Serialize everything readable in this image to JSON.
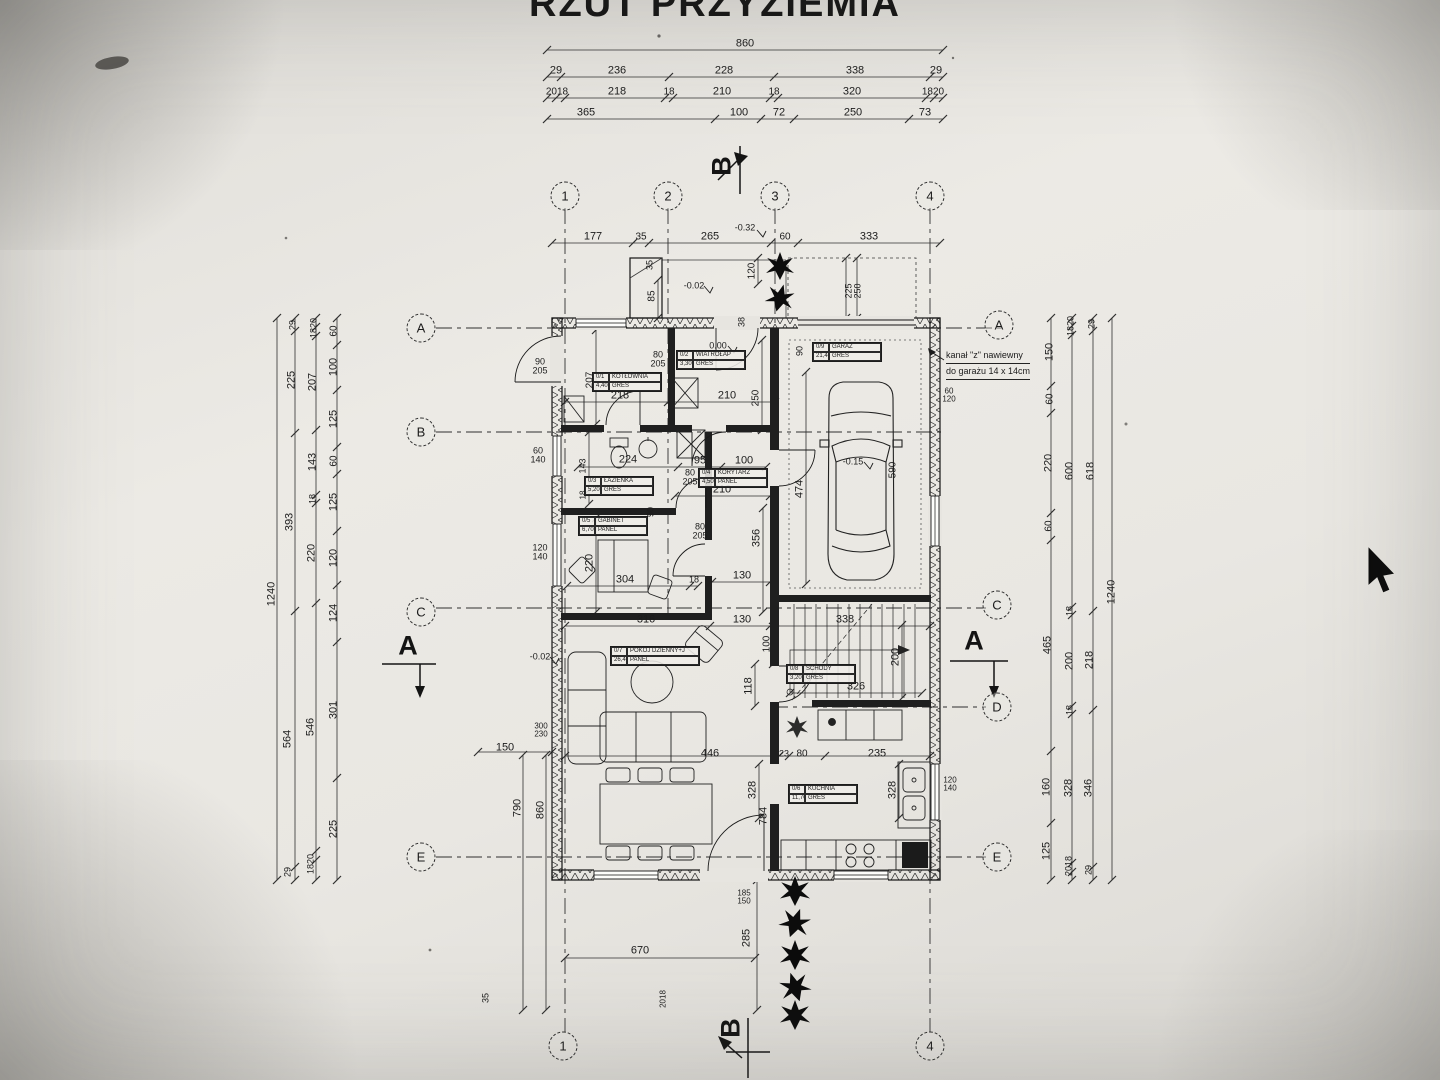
{
  "title": "RZUT PRZYZIEMIA",
  "note": {
    "line1": "kanał \"z\" nawiewny",
    "line2": "do garażu 14 x 14cm"
  },
  "rooms": [
    {
      "id": "0/1",
      "name": "KOTŁOWNIA",
      "area": "4,40m²",
      "floor": "GRES",
      "x": 592,
      "y": 372
    },
    {
      "id": "0/2",
      "name": "WIATROŁAP",
      "area": "3,30m²",
      "floor": "GRES",
      "x": 676,
      "y": 350
    },
    {
      "id": "0/3",
      "name": "ŁAZIENKA",
      "area": "5,20m²",
      "floor": "GRES",
      "x": 584,
      "y": 476
    },
    {
      "id": "0/4",
      "name": "KORYTARZ",
      "area": "4,50m²",
      "floor": "PANEL",
      "x": 698,
      "y": 468
    },
    {
      "id": "0/5",
      "name": "GABINET",
      "area": "6,70m²",
      "floor": "PANEL",
      "x": 578,
      "y": 516
    },
    {
      "id": "0/7",
      "name": "POKÓJ DZIENNY+J",
      "area": "26,40m²",
      "floor": "PANEL",
      "x": 610,
      "y": 646,
      "wide": true
    },
    {
      "id": "0/8",
      "name": "SCHODY",
      "area": "3,20m²",
      "floor": "GRES",
      "x": 786,
      "y": 664
    },
    {
      "id": "0/6",
      "name": "KUCHNIA",
      "area": "11,70m²",
      "floor": "GRES",
      "x": 788,
      "y": 784
    },
    {
      "id": "0/9",
      "name": "GARAŻ",
      "area": "21,40m²",
      "floor": "GRES",
      "x": 812,
      "y": 342
    }
  ],
  "grid_bubbles": [
    {
      "label": "1",
      "x": 565,
      "y": 196
    },
    {
      "label": "2",
      "x": 668,
      "y": 196
    },
    {
      "label": "3",
      "x": 775,
      "y": 196
    },
    {
      "label": "4",
      "x": 930,
      "y": 196
    },
    {
      "label": "1",
      "x": 563,
      "y": 1046
    },
    {
      "label": "4",
      "x": 930,
      "y": 1046
    },
    {
      "label": "A",
      "x": 421,
      "y": 328
    },
    {
      "label": "B",
      "x": 421,
      "y": 432
    },
    {
      "label": "C",
      "x": 421,
      "y": 612
    },
    {
      "label": "E",
      "x": 421,
      "y": 857
    },
    {
      "label": "A",
      "x": 999,
      "y": 325
    },
    {
      "label": "C",
      "x": 997,
      "y": 605
    },
    {
      "label": "D",
      "x": 997,
      "y": 707
    },
    {
      "label": "E",
      "x": 997,
      "y": 857
    }
  ],
  "section_marks": [
    {
      "label": "A",
      "x": 408,
      "y": 646,
      "rot": false
    },
    {
      "label": "A",
      "x": 974,
      "y": 641,
      "rot": false
    },
    {
      "label": "B",
      "x": 722,
      "y": 166,
      "rot": true
    },
    {
      "label": "B",
      "x": 731,
      "y": 1028,
      "rot": true
    }
  ],
  "labels": [
    [
      "860",
      745,
      44
    ],
    [
      "29",
      556,
      71
    ],
    [
      "236",
      617,
      71
    ],
    [
      "228",
      724,
      71
    ],
    [
      "338",
      855,
      71
    ],
    [
      "29",
      936,
      71
    ],
    [
      "2018",
      557,
      92,
      0,
      10
    ],
    [
      "218",
      617,
      92
    ],
    [
      "18",
      669,
      92,
      0,
      10
    ],
    [
      "210",
      722,
      92
    ],
    [
      "18",
      774,
      92,
      0,
      10
    ],
    [
      "320",
      852,
      92
    ],
    [
      "1820",
      933,
      92,
      0,
      10
    ],
    [
      "365",
      586,
      113
    ],
    [
      "100",
      739,
      113
    ],
    [
      "72",
      779,
      113
    ],
    [
      "250",
      853,
      113
    ],
    [
      "73",
      925,
      113
    ],
    [
      "177",
      593,
      237
    ],
    [
      "35",
      641,
      237,
      0,
      10
    ],
    [
      "265",
      710,
      237
    ],
    [
      "60",
      785,
      237,
      0,
      10
    ],
    [
      "333",
      869,
      237
    ],
    [
      "-0.32",
      745,
      228,
      0,
      9
    ],
    [
      "1240",
      272,
      594,
      1
    ],
    [
      "29",
      293,
      325,
      1,
      9
    ],
    [
      "225",
      292,
      380,
      1
    ],
    [
      "393",
      290,
      522,
      1
    ],
    [
      "564",
      288,
      739,
      1
    ],
    [
      "29",
      288,
      872,
      1,
      9
    ],
    [
      "1820",
      314,
      328,
      1,
      9
    ],
    [
      "207",
      313,
      382,
      1
    ],
    [
      "143",
      313,
      462,
      1
    ],
    [
      "18",
      313,
      499,
      1,
      9
    ],
    [
      "220",
      312,
      553,
      1
    ],
    [
      "546",
      311,
      727,
      1
    ],
    [
      "1820",
      311,
      864,
      1,
      9
    ],
    [
      "60",
      334,
      331,
      1,
      10
    ],
    [
      "100",
      334,
      367,
      1
    ],
    [
      "125",
      334,
      419,
      1
    ],
    [
      "60",
      334,
      461,
      1,
      10
    ],
    [
      "125",
      334,
      502,
      1
    ],
    [
      "120",
      334,
      558,
      1
    ],
    [
      "124",
      334,
      613,
      1
    ],
    [
      "301",
      334,
      710,
      1
    ],
    [
      "225",
      334,
      829,
      1
    ],
    [
      "150",
      1050,
      352,
      1
    ],
    [
      "60",
      1050,
      399,
      1,
      10
    ],
    [
      "220",
      1049,
      463,
      1
    ],
    [
      "60",
      1049,
      526,
      1,
      10
    ],
    [
      "465",
      1048,
      645,
      1
    ],
    [
      "160",
      1047,
      787,
      1
    ],
    [
      "125",
      1047,
      851,
      1
    ],
    [
      "1820",
      1071,
      326,
      1,
      9
    ],
    [
      "600",
      1070,
      471,
      1
    ],
    [
      "18",
      1070,
      611,
      1,
      9
    ],
    [
      "200",
      1070,
      661,
      1
    ],
    [
      "18",
      1070,
      710,
      1,
      9
    ],
    [
      "328",
      1069,
      788,
      1
    ],
    [
      "2018",
      1069,
      866,
      1,
      9
    ],
    [
      "29",
      1092,
      324,
      1,
      9
    ],
    [
      "618",
      1091,
      471,
      1
    ],
    [
      "218",
      1090,
      660,
      1
    ],
    [
      "346",
      1089,
      788,
      1
    ],
    [
      "29",
      1089,
      870,
      1,
      9
    ],
    [
      "1240",
      1112,
      592,
      1
    ],
    [
      "150",
      505,
      748
    ],
    [
      "790",
      518,
      808,
      1
    ],
    [
      "860",
      541,
      810,
      1
    ],
    [
      "35",
      486,
      998,
      1,
      9
    ],
    [
      "670",
      640,
      951
    ],
    [
      "285",
      747,
      938,
      1
    ],
    [
      "185",
      744,
      893,
      0,
      8
    ],
    [
      "150",
      744,
      901,
      0,
      8
    ],
    [
      "300",
      541,
      726,
      0,
      8
    ],
    [
      "230",
      541,
      734,
      0,
      8
    ],
    [
      "2018",
      663,
      999,
      1,
      8
    ],
    [
      "207",
      590,
      380,
      1,
      10
    ],
    [
      "218",
      620,
      396
    ],
    [
      "210",
      727,
      396
    ],
    [
      "250",
      756,
      398,
      1,
      10
    ],
    [
      "80",
      658,
      355,
      0,
      9
    ],
    [
      "205",
      658,
      364,
      0,
      9
    ],
    [
      "0.00",
      718,
      346,
      0,
      9
    ],
    [
      "-0.02",
      694,
      286,
      0,
      9
    ],
    [
      "85",
      652,
      296,
      1,
      10
    ],
    [
      "35",
      650,
      265,
      1,
      9
    ],
    [
      "120",
      752,
      271,
      1,
      10
    ],
    [
      "38",
      742,
      322,
      1,
      9
    ],
    [
      "90",
      800,
      351,
      1,
      9
    ],
    [
      "225",
      849,
      291,
      1,
      9
    ],
    [
      "250",
      858,
      291,
      1,
      9
    ],
    [
      "224",
      628,
      460
    ],
    [
      "95",
      700,
      461
    ],
    [
      "100",
      744,
      461
    ],
    [
      "210",
      722,
      490
    ],
    [
      "143",
      583,
      466,
      1,
      9
    ],
    [
      "18",
      583,
      495,
      1,
      8
    ],
    [
      "80",
      690,
      473,
      0,
      9
    ],
    [
      "205",
      690,
      482,
      0,
      9
    ],
    [
      "90",
      651,
      512,
      1,
      9
    ],
    [
      "80",
      700,
      527,
      0,
      9
    ],
    [
      "205",
      700,
      536,
      0,
      9
    ],
    [
      "304",
      625,
      580
    ],
    [
      "18",
      694,
      580,
      0,
      9
    ],
    [
      "220",
      590,
      563,
      1
    ],
    [
      "316",
      646,
      620
    ],
    [
      "130",
      742,
      576
    ],
    [
      "130",
      742,
      620
    ],
    [
      "356",
      757,
      538,
      1
    ],
    [
      "100",
      767,
      644,
      1,
      10
    ],
    [
      "118",
      749,
      686,
      1
    ],
    [
      "-0.02",
      540,
      657,
      0,
      9
    ],
    [
      "474",
      800,
      489,
      1
    ],
    [
      "-0.15",
      853,
      462,
      0,
      9
    ],
    [
      "590",
      893,
      470,
      1,
      10
    ],
    [
      "60",
      949,
      391,
      0,
      8
    ],
    [
      "120",
      949,
      399,
      0,
      8
    ],
    [
      "338",
      845,
      620
    ],
    [
      "200",
      896,
      657,
      1
    ],
    [
      "326",
      856,
      687
    ],
    [
      "446",
      710,
      754
    ],
    [
      "23",
      784,
      754,
      0,
      9
    ],
    [
      "80",
      802,
      754,
      0,
      10
    ],
    [
      "235",
      877,
      754
    ],
    [
      "328",
      753,
      790,
      1
    ],
    [
      "784",
      764,
      816,
      1
    ],
    [
      "328",
      893,
      790,
      1
    ],
    [
      "120",
      950,
      780,
      0,
      8
    ],
    [
      "140",
      950,
      788,
      0,
      8
    ],
    [
      "90",
      540,
      362,
      0,
      9
    ],
    [
      "205",
      540,
      371,
      0,
      9
    ],
    [
      "60",
      538,
      451,
      0,
      9
    ],
    [
      "140",
      538,
      460,
      0,
      9
    ],
    [
      "120",
      540,
      548,
      0,
      9
    ],
    [
      "140",
      540,
      557,
      0,
      9
    ]
  ]
}
